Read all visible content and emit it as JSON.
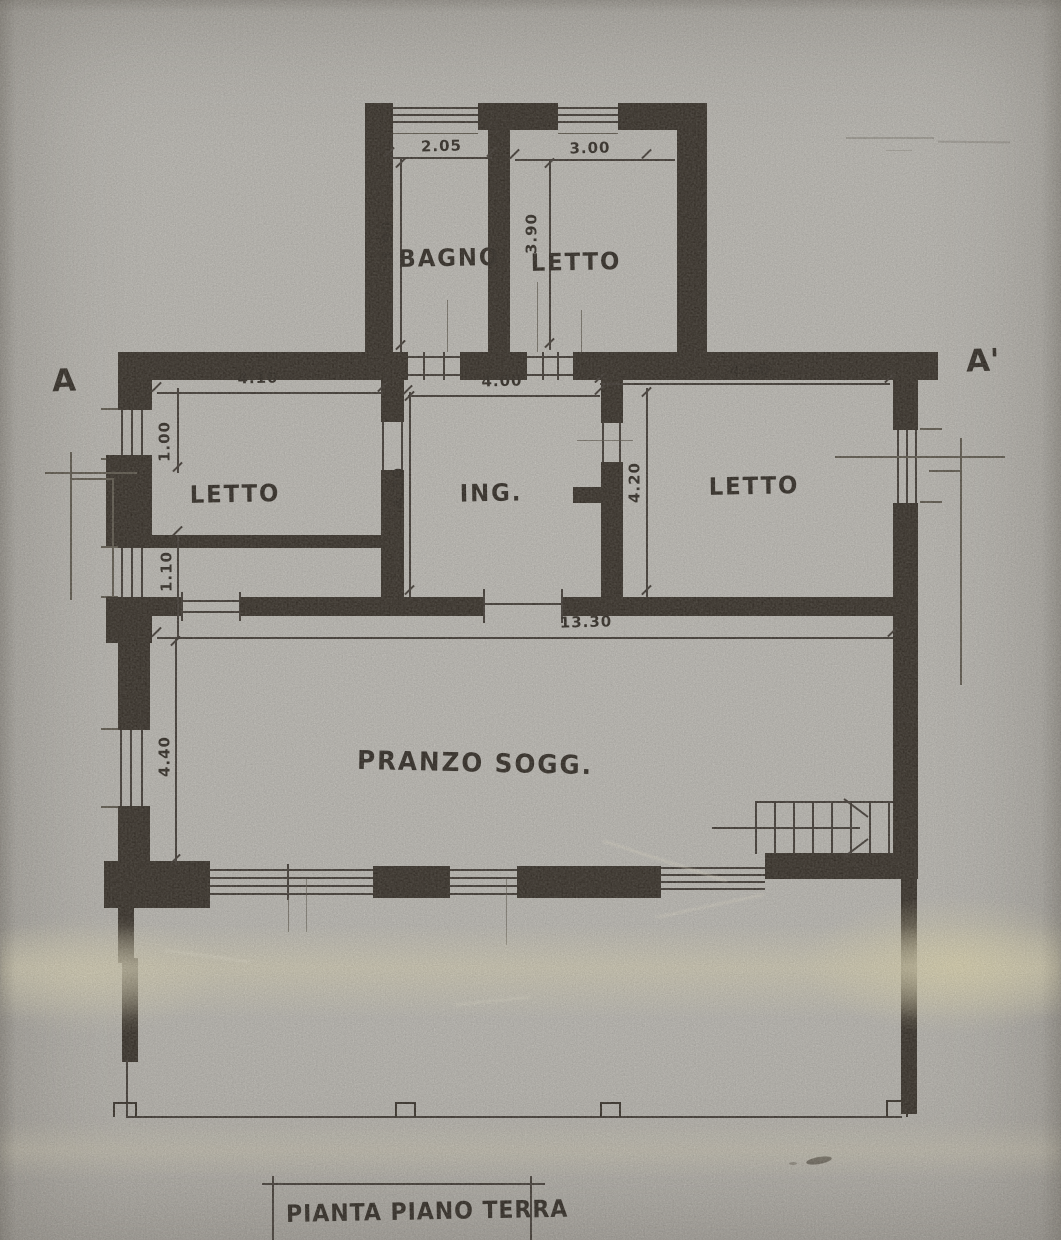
{
  "sheet": {
    "title": "PIANTA PIANO TERRA"
  },
  "section_markers": {
    "left": "A",
    "right": "A'"
  },
  "rooms": {
    "bagno": "BAGNO",
    "letto_top": "LETTO",
    "letto_left": "LETTO",
    "ingresso": "ING.",
    "letto_right": "LETTO",
    "pranzo": "PRANZO SOGG."
  },
  "dimensions": {
    "bagno_width": "2.05",
    "letto_top_width": "3.00",
    "bagno_depth": "3.90",
    "letto_top_depth": "3.90",
    "letto_left_width": "4.10",
    "ingresso_width": "4.00",
    "letto_right_width": "4.90",
    "ingresso_depth": "4.20",
    "letto_right_depth": "4.20",
    "left_window_segment": "1.00",
    "corridor_width": "1.10",
    "overall_width": "13.30",
    "pranzo_depth": "4.40"
  }
}
